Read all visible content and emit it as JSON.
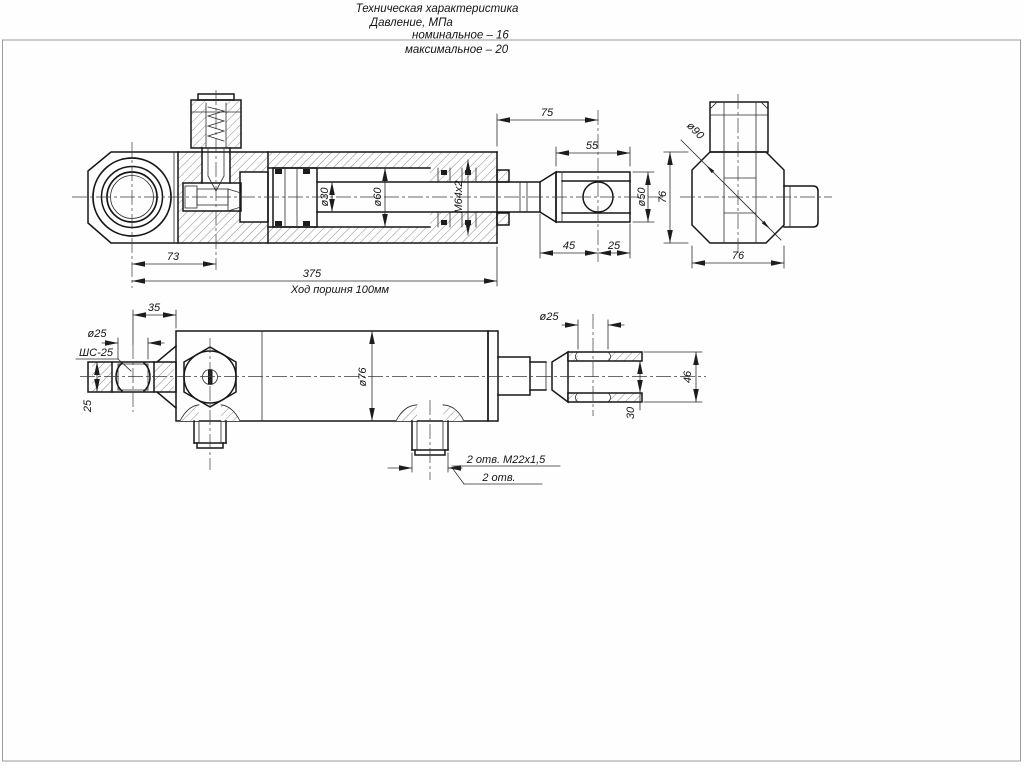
{
  "page": {
    "bg": "#fefefe",
    "frame_color": "#9c9c9c",
    "line_color": "#161616"
  },
  "tech_spec": {
    "title": "Техническая характеристика",
    "pressure_label": "Давление, МПа",
    "nominal": "номинальное  –  16",
    "maximal": "максимальное – 20"
  },
  "section_view": {
    "dims": {
      "len_75": "75",
      "len_55": "55",
      "rod_dia": "ø30",
      "bore_dia": "ø60",
      "gland_thread": "M64x2",
      "clevis_dia": "ø50",
      "len_45": "45",
      "len_25": "25",
      "len_73": "73",
      "len_375": "375",
      "stroke_note": "Ход поршня 100мм"
    }
  },
  "side_view": {
    "dims": {
      "diag_dia": "ø90",
      "height": "76",
      "width": "76"
    }
  },
  "top_view": {
    "dims": {
      "len_35": "35",
      "eye_bore": "ø25",
      "bearing_type": "ШС-25",
      "plate_thk": "25",
      "body_dia": "ø76",
      "clevis_bore": "ø25",
      "clevis_width": "46",
      "slot_width": "30",
      "ports_thread": "2 отв. М22х1,5",
      "ports_count": "2 отв."
    }
  }
}
